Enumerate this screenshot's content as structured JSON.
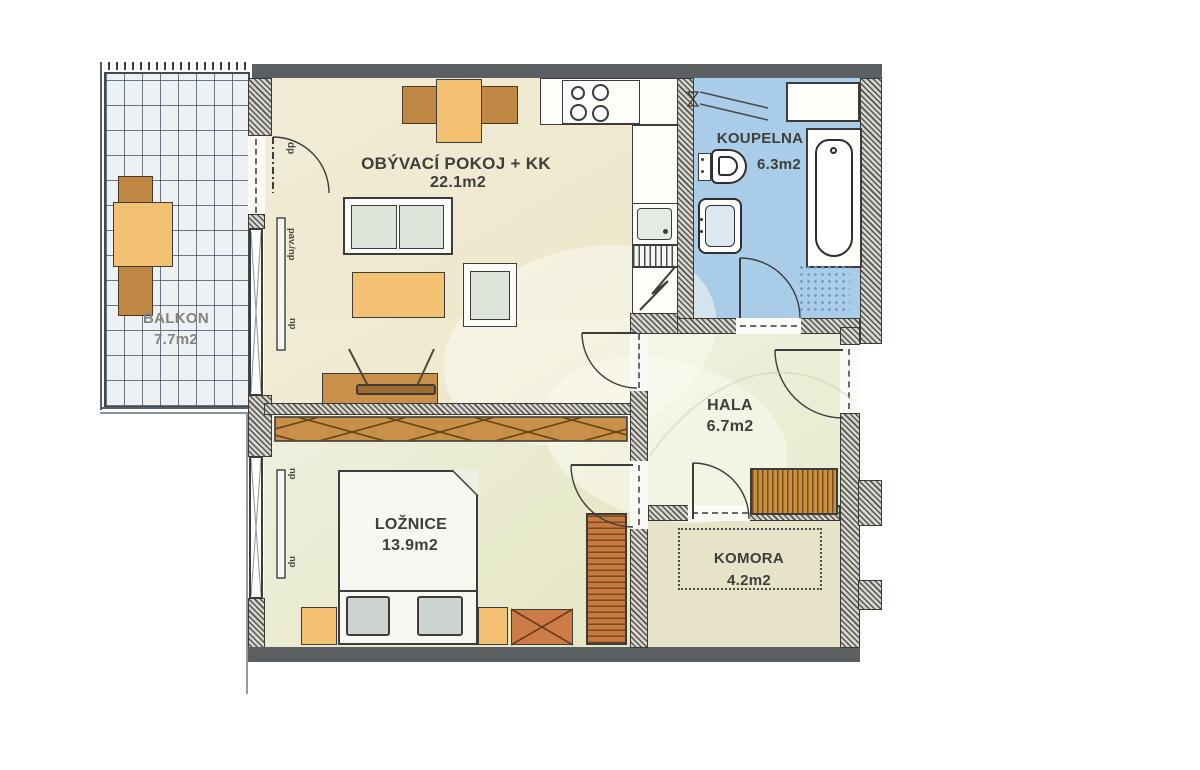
{
  "plan": {
    "rooms": {
      "living": {
        "label": "OBÝVACÍ POKOJ + KK",
        "area": "22.1m2"
      },
      "balcony": {
        "label": "BALKON",
        "area": "7.7m2"
      },
      "bathroom": {
        "label": "KOUPELNA",
        "area": "6.3m2"
      },
      "hall": {
        "label": "HALA",
        "area": "6.7m2"
      },
      "bedroom": {
        "label": "LOŽNICE",
        "area": "13.9m2"
      },
      "storage": {
        "label": "KOMORA",
        "area": "4.2m2"
      }
    },
    "annotations": {
      "balcony_door": "dp",
      "living_window_1": "pav./np",
      "living_window_2": "np",
      "bedroom_window_1": "np",
      "bedroom_window_2": "np"
    },
    "colors": {
      "bathroom_floor": "#a9cde8",
      "living_floor": "#efe9d1",
      "bedroom_floor": "#e9eace",
      "hall_floor": "#eaecd2",
      "storage_floor": "#e6e3c9",
      "balcony_floor": "#eef1f4",
      "wood_furniture": "#c9904a",
      "table_accent": "#f2c171",
      "wall": "#55544e"
    }
  }
}
